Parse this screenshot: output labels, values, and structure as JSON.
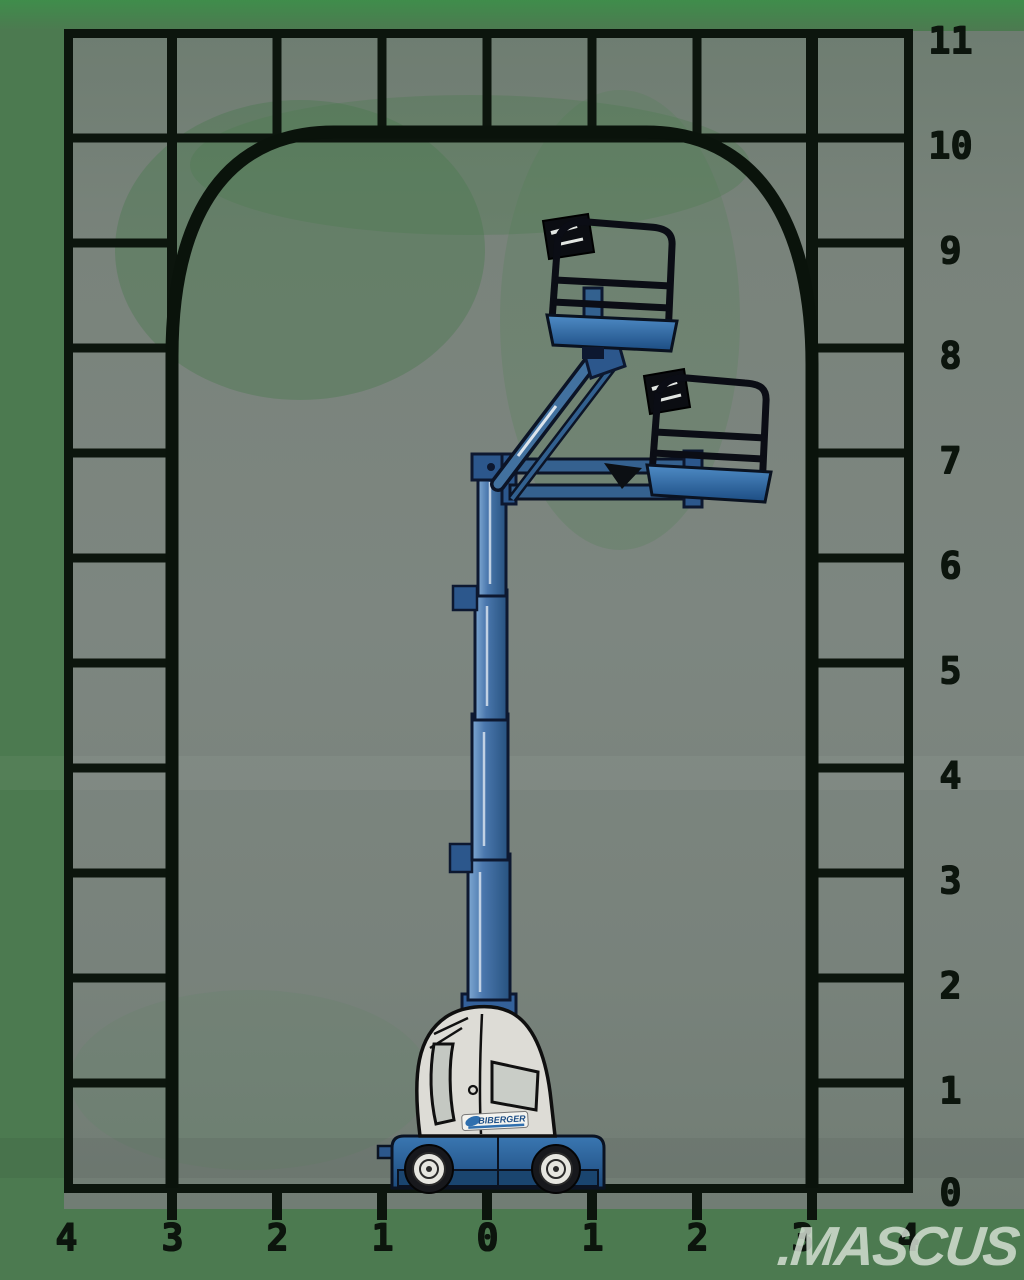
{
  "diagram": {
    "kind": "mast-boom-lift working envelope",
    "x_range_m": [
      -4,
      4
    ],
    "y_range_m": [
      0,
      11
    ],
    "grid_unit_m": 1,
    "envelope_max_height_m": 10,
    "envelope_half_width_m": 3
  },
  "axes": {
    "right_labels": [
      "11",
      "10",
      "9",
      "8",
      "7",
      "6",
      "5",
      "4",
      "3",
      "2",
      "1",
      "0"
    ],
    "bottom_labels": [
      "4",
      "3",
      "2",
      "1",
      "0",
      "1",
      "2",
      "3",
      "4"
    ]
  },
  "machine": {
    "brand_logo_text": "BIBERGER"
  },
  "watermark": {
    "text": ".MASCUS"
  },
  "colors": {
    "background_green": "#4c7a50",
    "top_band_green": "#3f8d4b",
    "panel_gray": "#7b847c",
    "grid_line": "#0c150d",
    "envelope_line": "#0a130b",
    "machine_blue": "#3b6ba4",
    "machine_dark_blue": "#1d4a7c",
    "turret_white": "#dddcd6",
    "watermark_gray": "#d6e1d5"
  }
}
